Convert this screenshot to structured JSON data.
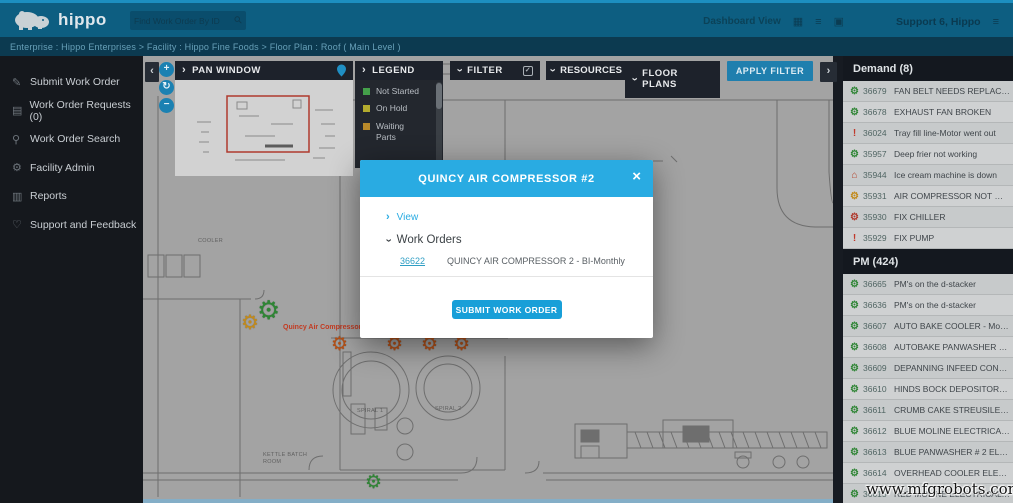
{
  "navbar": {
    "logo_text": "hippo",
    "search_placeholder": "Find Work Order By ID",
    "dashboard_view_label": "Dashboard View",
    "user_label": "Support 6, Hippo"
  },
  "breadcrumb": {
    "text": "Enterprise : Hippo Enterprises > Facility : Hippo Fine Foods > Floor Plan : Roof ( Main Level )"
  },
  "sidebar": {
    "items": [
      {
        "label": "Submit Work Order",
        "icon": "pencil"
      },
      {
        "label": "Work Order Requests (0)",
        "icon": "clipboard"
      },
      {
        "label": "Work Order Search",
        "icon": "search"
      },
      {
        "label": "Facility Admin",
        "icon": "gear"
      },
      {
        "label": "Reports",
        "icon": "chart"
      },
      {
        "label": "Support and Feedback",
        "icon": "heart"
      }
    ]
  },
  "toolbar": {
    "pan_window_label": "PAN WINDOW",
    "legend_label": "LEGEND",
    "filter_label": "FILTER",
    "resources_label": "RESOURCES",
    "floor_plans_label": "FLOOR PLANS",
    "apply_filter_label": "APPLY FILTER",
    "collapse_chevron": "‹",
    "expand_chevron": "›",
    "zoom_in": "+",
    "zoom_reset": "↻",
    "zoom_out": "−"
  },
  "legend": {
    "items": [
      {
        "label": "Not Started",
        "color": "#44a04a"
      },
      {
        "label": "On Hold",
        "color": "#b3ab2e"
      },
      {
        "label": "Waiting Parts",
        "color": "#b8892a"
      }
    ]
  },
  "map": {
    "asset_label": "Quincy Air Compressor",
    "room_labels": [
      {
        "text": "COOLER",
        "x": 55,
        "y": 182
      },
      {
        "text": "BLUE\nPACKAGING",
        "x": 252,
        "y": 204
      },
      {
        "text": "SPIRAL 1",
        "x": 214,
        "y": 352
      },
      {
        "text": "SPIRAL 2",
        "x": 292,
        "y": 350
      },
      {
        "text": "KETTLE BATCH\nROOM",
        "x": 120,
        "y": 396
      }
    ],
    "markers": [
      {
        "icon": "gear",
        "color": "#c28a1a",
        "x": 98,
        "y": 257,
        "size": 20
      },
      {
        "icon": "gear",
        "color": "#2f8535",
        "x": 114,
        "y": 241,
        "size": 26
      },
      {
        "icon": "gear",
        "color": "#b55016",
        "x": 188,
        "y": 279,
        "size": 19
      },
      {
        "icon": "gear",
        "color": "#b55016",
        "x": 243,
        "y": 279,
        "size": 19
      },
      {
        "icon": "gear",
        "color": "#b55016",
        "x": 278,
        "y": 279,
        "size": 19
      },
      {
        "icon": "gear",
        "color": "#b55016",
        "x": 310,
        "y": 279,
        "size": 19
      },
      {
        "icon": "gear",
        "color": "#2f8535",
        "x": 222,
        "y": 417,
        "size": 19
      }
    ]
  },
  "modal": {
    "title": "QUINCY AIR COMPRESSOR #2",
    "close_label": "×",
    "view_label": "View",
    "work_orders_label": "Work Orders",
    "work_order": {
      "id": "36622",
      "name": "QUINCY AIR COMPRESSOR 2 - BI-Monthly"
    },
    "submit_label": "SUBMIT WORK ORDER"
  },
  "right_panel": {
    "demand": {
      "title": "Demand (8)",
      "items": [
        {
          "id": "36679",
          "label": "FAN BELT NEEDS REPLACEMENT",
          "icon": "gear",
          "color": "#2f8535"
        },
        {
          "id": "36678",
          "label": "EXHAUST FAN BROKEN",
          "icon": "gear",
          "color": "#2f8535"
        },
        {
          "id": "36024",
          "label": "Tray fill line-Motor went out",
          "icon": "alert",
          "color": "#c0392b"
        },
        {
          "id": "35957",
          "label": "Deep frier not working",
          "icon": "gear",
          "color": "#2f8535"
        },
        {
          "id": "35944",
          "label": "Ice cream machine is down",
          "icon": "home",
          "color": "#b5432a"
        },
        {
          "id": "35931",
          "label": "AIR COMPRESSOR NOT WORKING",
          "icon": "gear",
          "color": "#c28a1a"
        },
        {
          "id": "35930",
          "label": "FIX CHILLER",
          "icon": "gear",
          "color": "#b03a2e"
        },
        {
          "id": "35929",
          "label": "FIX PUMP",
          "icon": "alert",
          "color": "#c0392b"
        }
      ]
    },
    "pm": {
      "title": "PM (424)",
      "items": [
        {
          "id": "36665",
          "label": "PM's on the d-stacker",
          "icon": "gear",
          "color": "#2f8535"
        },
        {
          "id": "36636",
          "label": "PM's on the d-stacker",
          "icon": "gear",
          "color": "#2f8535"
        },
        {
          "id": "36607",
          "label": "AUTO BAKE COOLER - Monthly",
          "icon": "gear",
          "color": "#2f8535"
        },
        {
          "id": "36608",
          "label": "AUTOBAKE PANWASHER MECHA...",
          "icon": "gear",
          "color": "#2f8535"
        },
        {
          "id": "36609",
          "label": "DEPANNING INFEED CONVEYORS...",
          "icon": "gear",
          "color": "#2f8535"
        },
        {
          "id": "36610",
          "label": "HINDS BOCK DEPOSITOR MECHA...",
          "icon": "gear",
          "color": "#2f8535"
        },
        {
          "id": "36611",
          "label": "CRUMB CAKE STREUSILER PM - BI...",
          "icon": "gear",
          "color": "#2f8535"
        },
        {
          "id": "36612",
          "label": "BLUE MOLINE ELECTRICAL PANEL...",
          "icon": "gear",
          "color": "#2f8535"
        },
        {
          "id": "36613",
          "label": "BLUE PANWASHER # 2 ELECTRICA...",
          "icon": "gear",
          "color": "#2f8535"
        },
        {
          "id": "36614",
          "label": "OVERHEAD COOLER ELECTRICAL ...",
          "icon": "gear",
          "color": "#2f8535"
        },
        {
          "id": "36615",
          "label": "RED MOLINE ELECTRICAL PANEL...",
          "icon": "gear",
          "color": "#2f8535"
        }
      ]
    }
  },
  "watermark": {
    "text": "www.mfgrobots.com"
  },
  "colors": {
    "accent_blue": "#29abe2",
    "navbar": "#0d5e81",
    "breadcrumb_bar": "#0c3a50",
    "panel_header": "#1d222b",
    "sidebar_bg": "#15181d",
    "map_bg": "#a3a3a3",
    "apply_filter_button": "#1f7fae",
    "viewport_rect": "#b03a2e"
  }
}
